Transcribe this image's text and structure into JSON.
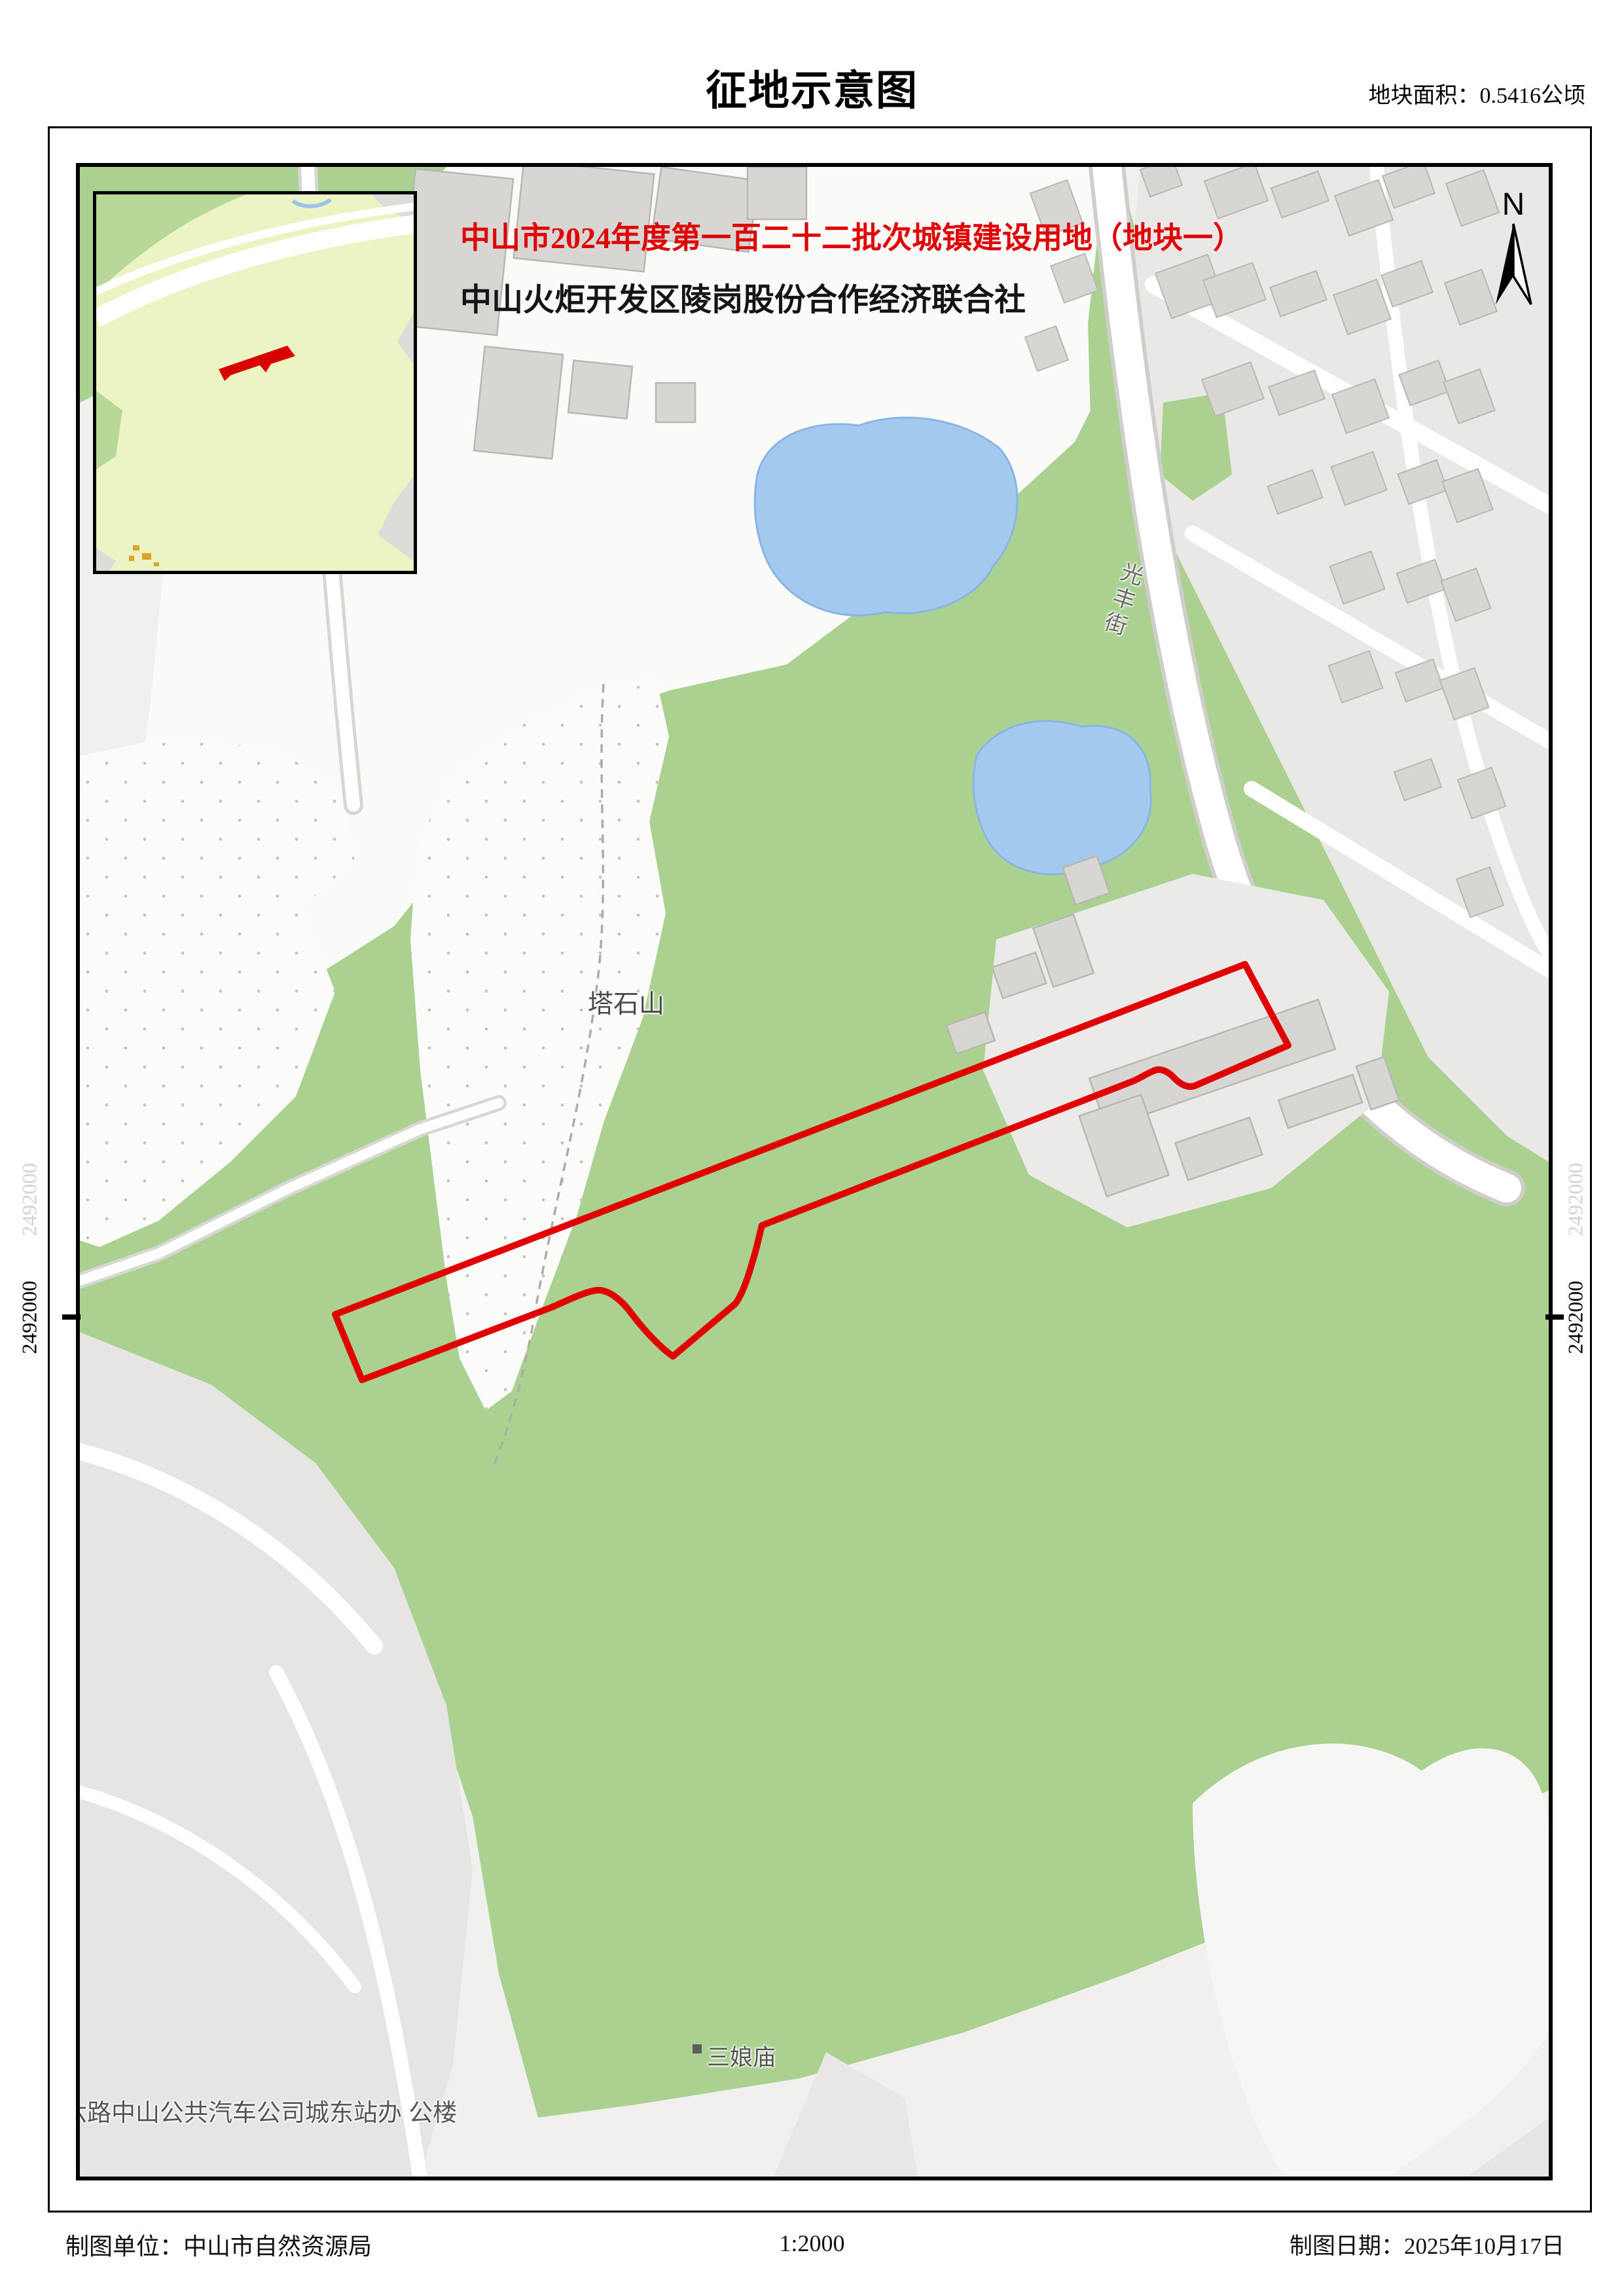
{
  "page": {
    "title": "征地示意图",
    "area_label": "地块面积：0.5416公顷"
  },
  "map": {
    "heading_red": "中山市2024年度第一百二十二批次城镇建设用地（地块一）",
    "heading_black": "中山火炬开发区陵岗股份合作经济联合社",
    "north_label": "N",
    "labels": {
      "hill": "塔石山",
      "street": "光丰街",
      "temple": "三娘庙",
      "bus_station": "六路中山公共汽车公司城东站办 公楼"
    },
    "grid_coordinate": "2492000",
    "colors": {
      "plot_outline": "#e00000",
      "vegetation": "#abd190",
      "water": "#a4c9ee",
      "building_fill": "#d8d6d3",
      "inset_bg": "#edf4c4"
    }
  },
  "footer": {
    "agency": "制图单位：中山市自然资源局",
    "scale": "1:2000",
    "date": "制图日期：2025年10月17日"
  }
}
